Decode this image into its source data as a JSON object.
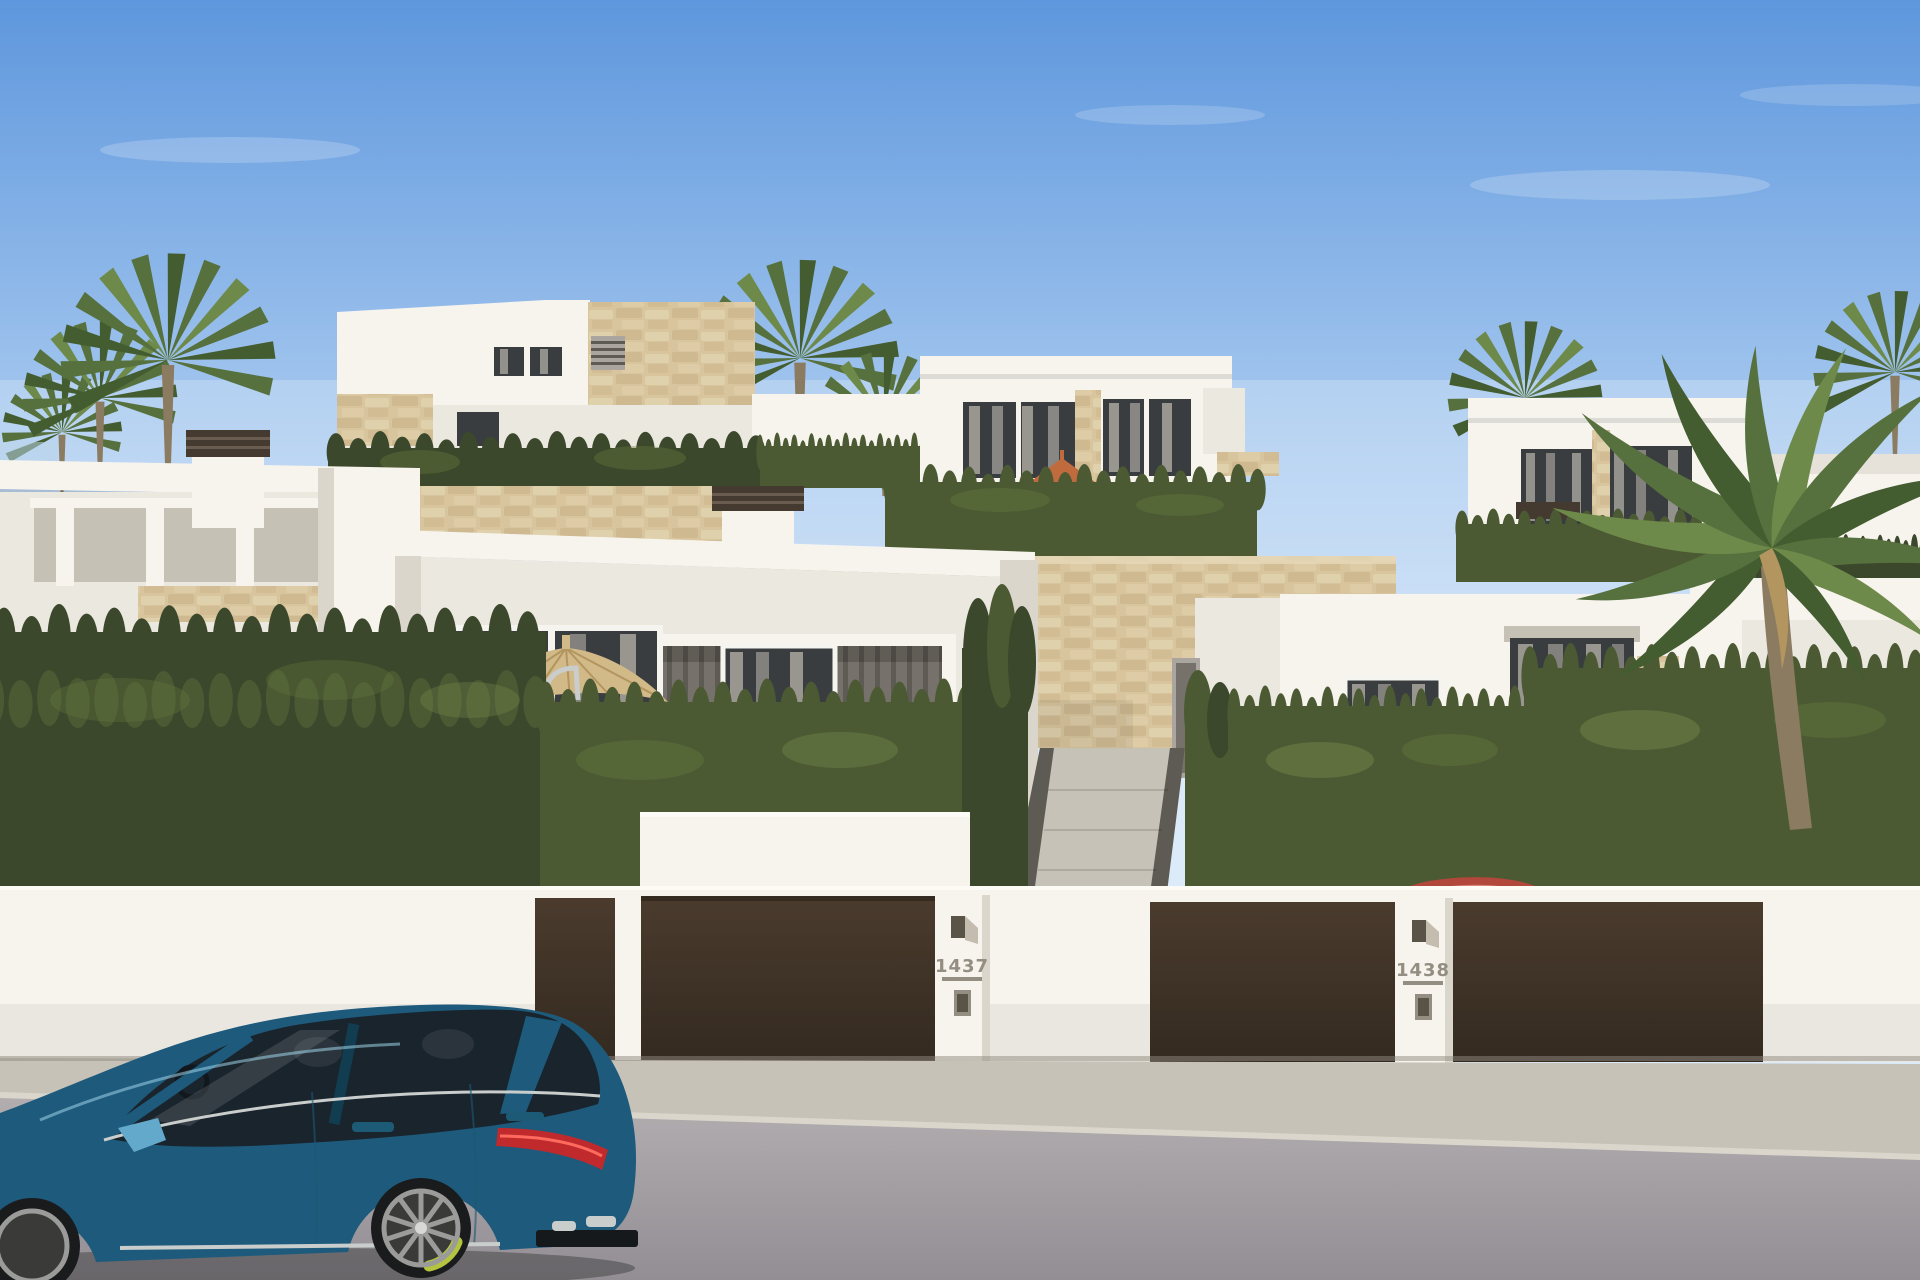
{
  "meta": {
    "title": "Street view 3D rendering of new-build white villas",
    "description": "Sunny architectural rendering: modern white villas with sandstone accents on a hillside, cypress hedges, dark brown driveway gates with numbered white posts, a straw parasol, palm trees, a blue Porsche wagon parked on the street and a red car inside the right driveway."
  },
  "text": {
    "house_number_left": "1437",
    "house_number_right": "1438"
  },
  "objects": [
    "blue-estate-car",
    "red-car",
    "driveway-gates",
    "house-number-posts",
    "white-villas",
    "stone-retaining-walls",
    "cypress-hedges",
    "palm-trees",
    "straw-parasol",
    "sidewalk",
    "asphalt-road",
    "blue-sky"
  ],
  "colors": {
    "sky_top": "#5e97dd",
    "sky_mid": "#a6c8ef",
    "sky_bottom": "#ddeafa",
    "cloud": "#ffffff",
    "wall_lit": "#f7f4ee",
    "wall_soft": "#ebe8e0",
    "wall_shade": "#dbd6cc",
    "wall_deep": "#c6c1b5",
    "stone": "#d8c59e",
    "stone_dark": "#c2ab80",
    "stone_light": "#e6d8b8",
    "hedge": "#4b5a33",
    "hedge_dark": "#3c482b",
    "hedge_light": "#64793f",
    "hedge_lit": "#7e9150",
    "palm": "#56713d",
    "palm_dark": "#435c30",
    "palm_light": "#6e8a4a",
    "trunk": "#8b7b60",
    "gate": "#342a20",
    "gate_light": "#4a3b2d",
    "window": "#3a3d40",
    "curtain": "#aaa69f",
    "frame": "#f6f4ee",
    "slat_wall": "#76726b",
    "slat_dark": "#5e5a54",
    "terracotta": "#c06b3e",
    "straw": "#d2b988",
    "straw_dark": "#b3955f",
    "sidewalk": "#c7c2b7",
    "curb": "#dad6cc",
    "road_light": "#b2aeb0",
    "road_dark": "#928e94",
    "car_body": "#2b7fa9",
    "car_body_light": "#63a9cb",
    "car_body_dark": "#1d5a7c",
    "car_glass": "#1a242c",
    "car_trim": "#c9cdcc",
    "brake_caliper": "#b4c43f",
    "tail_light": "#c02a2c",
    "wheel": "#9b9b99",
    "tire": "#191b1d",
    "red_car": "#b2473c",
    "red_car_glass": "#23262b",
    "number_text": "#948e82",
    "metal_dark": "#5a5348",
    "chimney_cap": "#453a30",
    "glass_balustrade": "#b9d5e7"
  }
}
